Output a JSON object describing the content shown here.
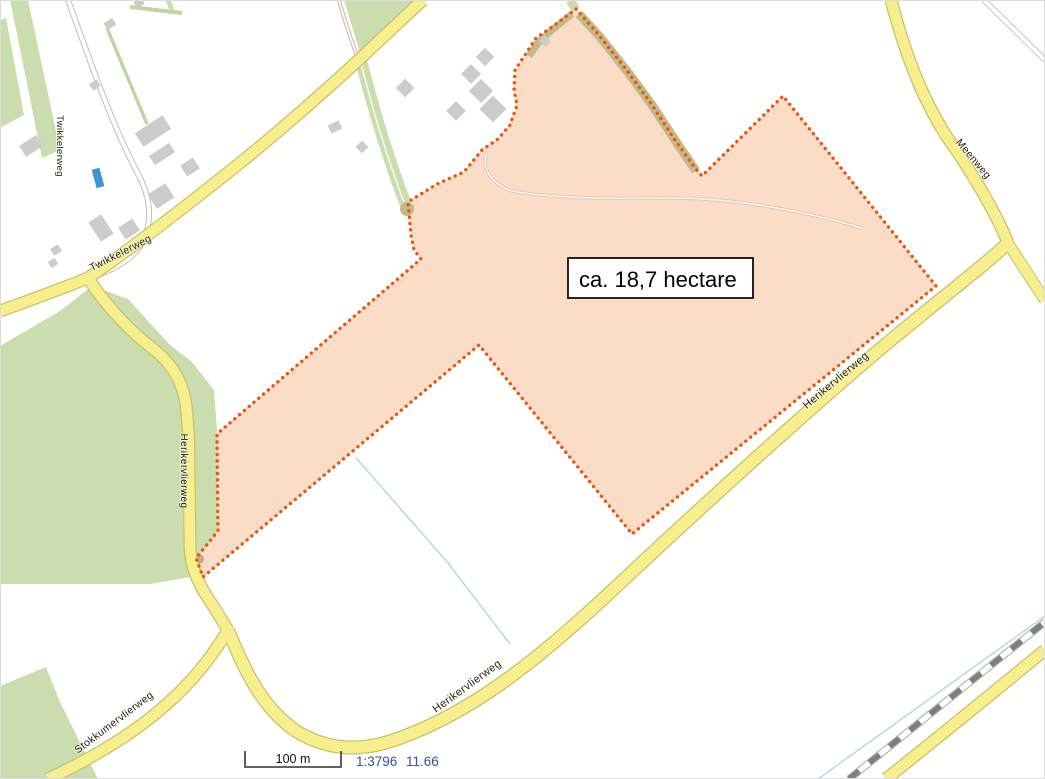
{
  "map": {
    "parcel": {
      "area_label": "ca. 18,7 hectare"
    },
    "road_labels": [
      {
        "id": "twikkelerweg-vertical",
        "text": "Twikkelerweg"
      },
      {
        "id": "twikkelerweg-diagonal",
        "text": "Twikkelerweg"
      },
      {
        "id": "herikervlierweg-north",
        "text": "Herikervlierweg"
      },
      {
        "id": "herikervlierweg-upper",
        "text": "Herikervlierweg"
      },
      {
        "id": "herikervlierweg-lower",
        "text": "Herikervlierweg"
      },
      {
        "id": "stokkumervlierweg",
        "text": "Stokkumervlierweg"
      },
      {
        "id": "meenweg",
        "text": "Meenweg"
      }
    ],
    "features": {
      "parcel": "selected land parcel",
      "railway": "railway line bottom right",
      "water_pool": "small blue basin at farmstead"
    }
  },
  "statusbar": {
    "scale_bar_label": "100 m",
    "scale_ratio": "1:3796",
    "zoom_level": "11.66"
  },
  "colors": {
    "parcel_fill": "#FBDCC7",
    "parcel_border": "#E8570E",
    "road_fill": "#F7EE8D",
    "road_casing": "#CBC06A",
    "green_area": "#CBDCAE",
    "tree_line_olive": "#C3BA8A",
    "building": "#CCCCCC",
    "water_line": "#B9D6E8",
    "water_fill": "#3E96CE",
    "railway_dark": "#7E7E7E",
    "status_text": "#3A4F96",
    "label_text": "#23230F"
  }
}
